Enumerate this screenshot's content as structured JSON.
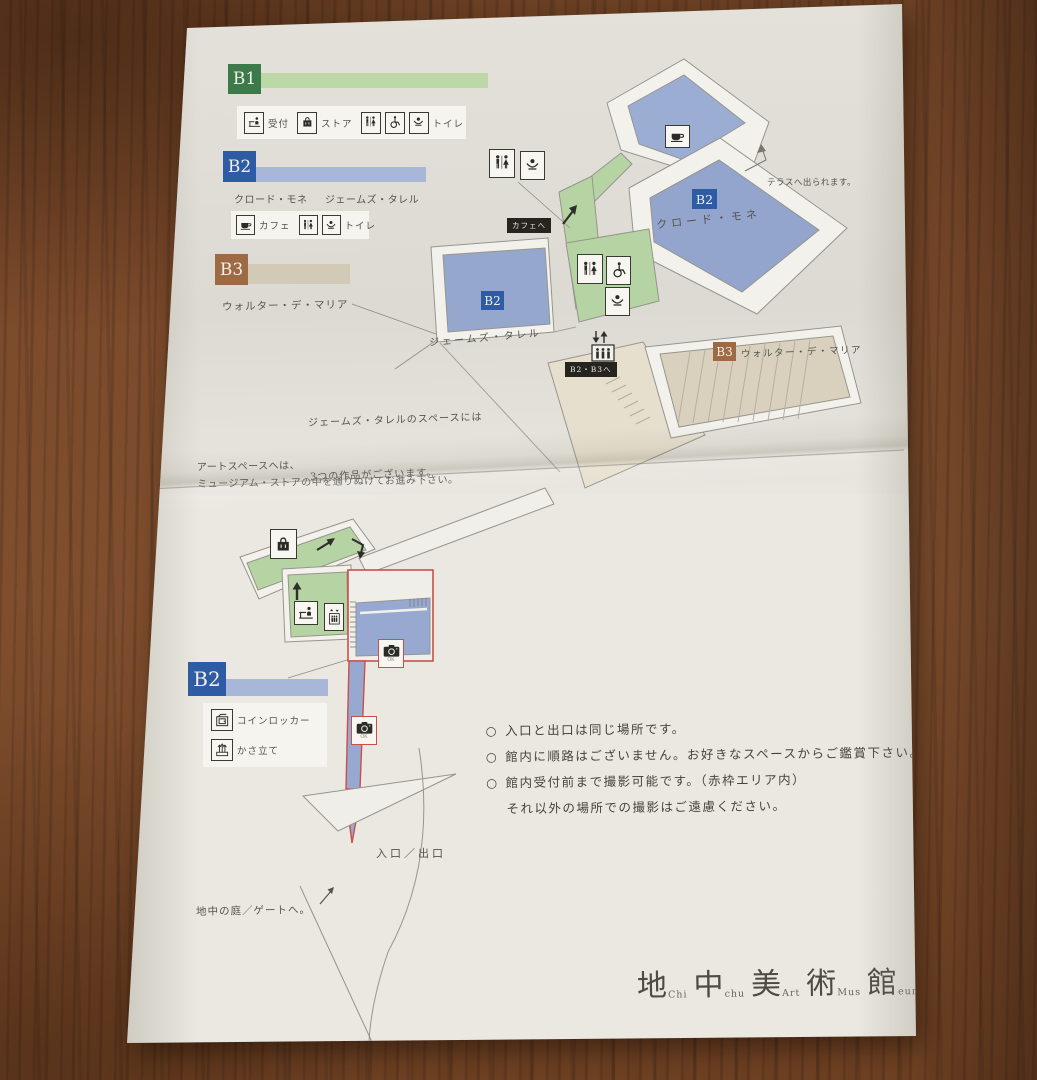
{
  "palette": {
    "paper": "#eae8e1",
    "wood": "#7b4a2b",
    "b1_green": "#3c7b49",
    "b1_bar": "#bdd8a7",
    "b2_blue": "#2d5ba4",
    "b2_bar": "#a8b7d8",
    "b3_brown": "#9e6a44",
    "b3_bar": "#d2c9b6",
    "floor_blue": "#96a7ce",
    "floor_green": "#b6d3a3",
    "floor_tan": "#d9d0bd",
    "accent_red": "#c9504a",
    "ink": "#55544e"
  },
  "legend_b1": {
    "badge": "B1",
    "reception": "受付",
    "store": "ストア",
    "toilet": "トイレ"
  },
  "legend_b2": {
    "badge": "B2",
    "monet": "クロード・モネ",
    "turrell": "ジェームズ・タレル",
    "cafe": "カフェ",
    "toilet": "トイレ"
  },
  "legend_b3": {
    "badge": "B3",
    "artist": "ウォルター・デ・マリア"
  },
  "legend_b2_lower": {
    "badge": "B2",
    "locker": "コインロッカー",
    "umbrella": "かさ立て"
  },
  "map": {
    "terrace_note": "テラスへ出られます。",
    "cafe_direction": "カフェへ",
    "monet": {
      "badge": "B2",
      "name": "クロード・モネ"
    },
    "turrell": {
      "badge": "B2",
      "name": "ジェームズ・タレル"
    },
    "de_maria": {
      "badge": "B3",
      "name": "ウォルター・デ・マリア"
    },
    "b2b3_direction": "B2・B3へ",
    "camera_ok": "OK",
    "turrell_note1": "ジェームズ・タレルのスペースには",
    "turrell_note2": "3つの作品がございます。",
    "artspace_note1": "アートスペースへは、",
    "artspace_note2": "ミュージアム・ストアの中を通りぬけてお進み下さい。",
    "entrance": "入口／出口",
    "garden": "地中の庭／ゲートへ。"
  },
  "notes": {
    "bullet": "○",
    "line1": "入口と出口は同じ場所です。",
    "line2": "館内に順路はございません。お好きなスペースからご鑑賞下さい。",
    "line3": "館内受付前まで撮影可能です。（赤枠エリア内）",
    "line4": "それ以外の場所での撮影はご遠慮ください。"
  },
  "logo": {
    "k1": "地",
    "l1": "Chi",
    "k2": "中",
    "l2": "chu",
    "k3": "美",
    "l3": "Art",
    "k4": "術",
    "l4": "Mus",
    "k5": "館",
    "l5": "eum"
  }
}
